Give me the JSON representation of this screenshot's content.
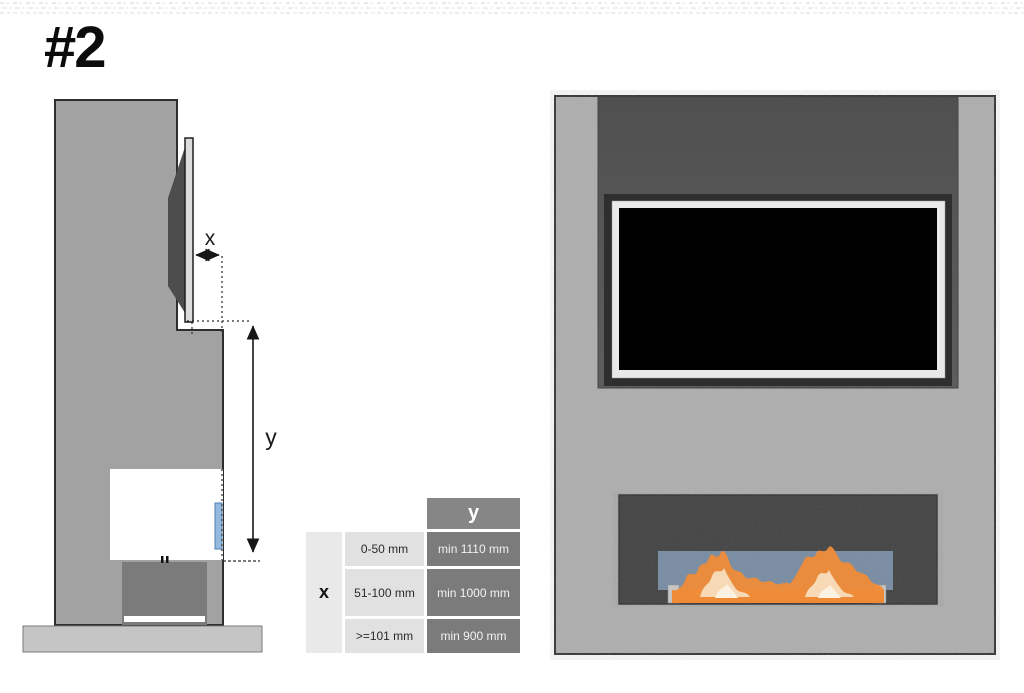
{
  "page": {
    "label": "#2"
  },
  "side_view": {
    "x_label": "x",
    "y_label": "y"
  },
  "table": {
    "row_header": "x",
    "col_header": "y",
    "rows": [
      {
        "x_range": "0-50 mm",
        "y_min": "min 1110 mm"
      },
      {
        "x_range": "51-100 mm",
        "y_min": "min 1000 mm"
      },
      {
        "x_range": ">=101 mm",
        "y_min": "min 900 mm"
      }
    ]
  },
  "colors": {
    "wall_front": "#b2b2b2",
    "wall_side": "#a2a2a2",
    "tv_niche": "#565656",
    "tv_screen": "#000000",
    "tv_frame": "#e9e9e9",
    "firebox": "#3c3c3c",
    "glass": "#8095ab",
    "glass_side_strip": "#93bade",
    "flame": "#ef8c38",
    "flame_highlight": "#f7d9b6",
    "table_dark_cell": "#7b7b7b",
    "table_light_cell": "#e1e1e1",
    "base_slab": "#c5c5c5"
  }
}
